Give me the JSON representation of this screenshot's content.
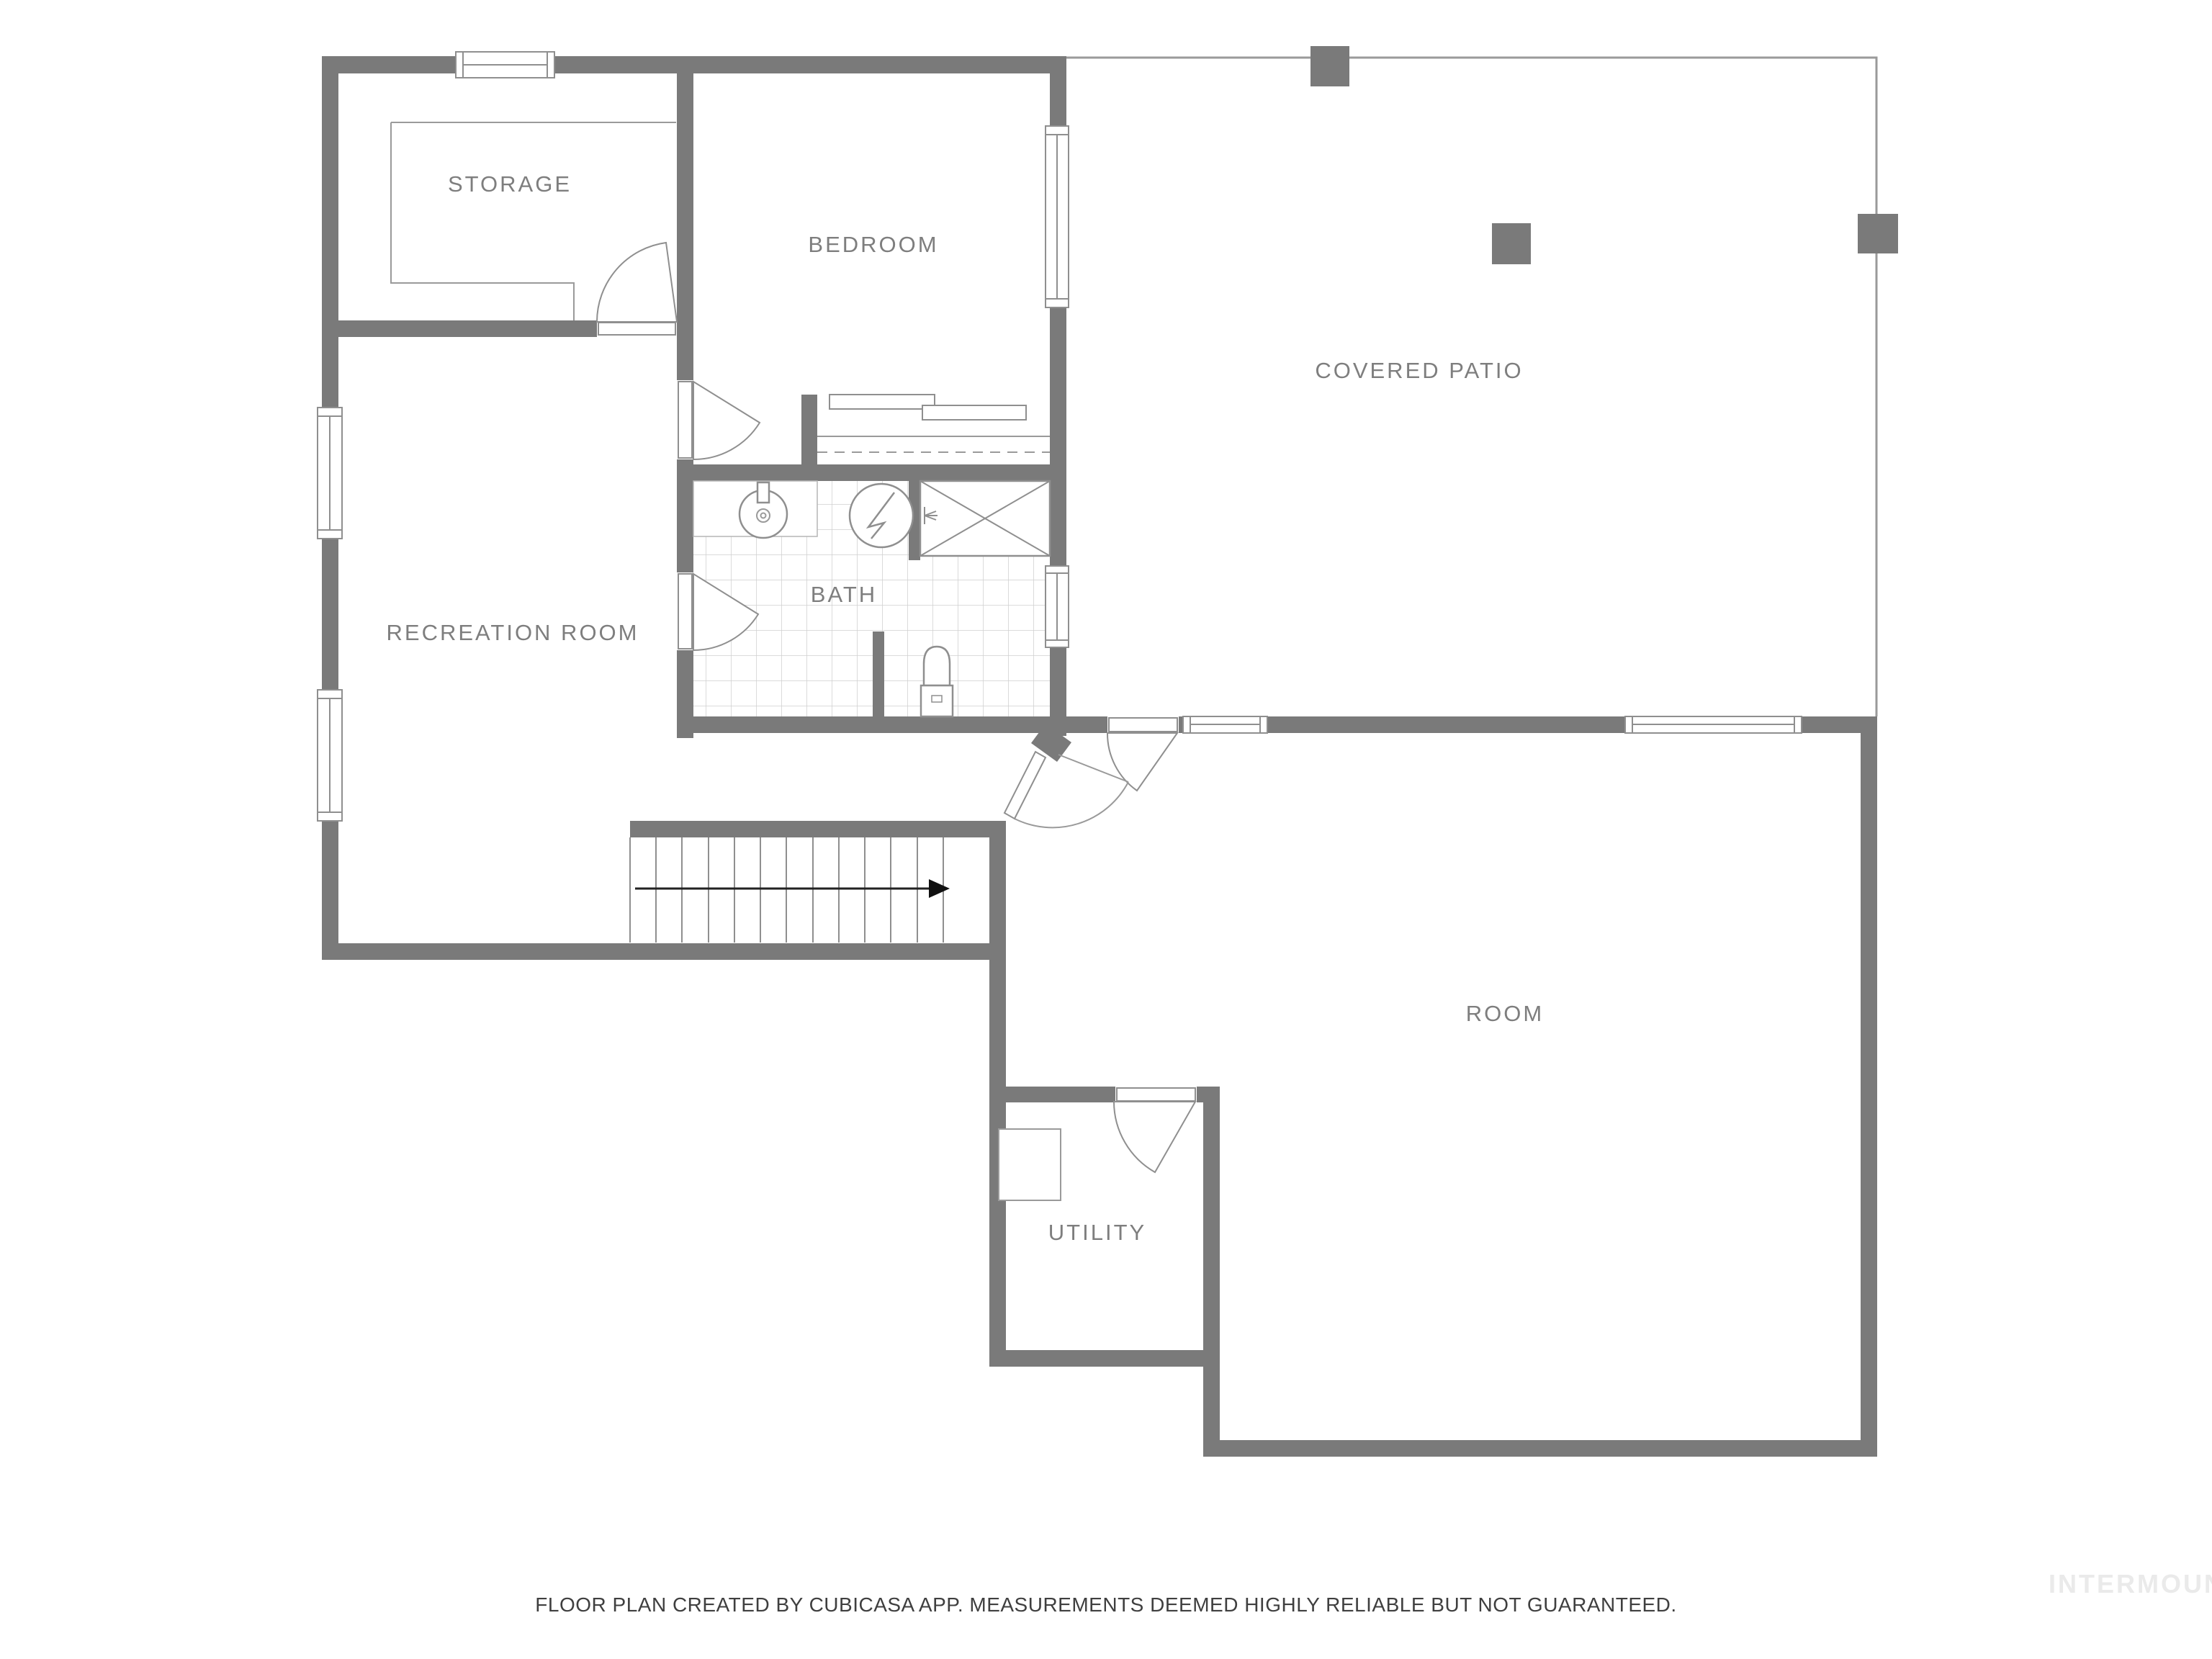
{
  "rooms": {
    "storage": {
      "label": "STORAGE"
    },
    "bedroom": {
      "label": "BEDROOM"
    },
    "covered_patio": {
      "label": "COVERED PATIO"
    },
    "recreation_room": {
      "label": "RECREATION ROOM"
    },
    "bath": {
      "label": "BATH"
    },
    "room": {
      "label": "ROOM"
    },
    "utility": {
      "label": "UTILITY"
    }
  },
  "footer": {
    "disclaimer": "FLOOR PLAN CREATED BY CUBICASA APP. MEASUREMENTS DEEMED HIGHLY RELIABLE BUT NOT GUARANTEED."
  },
  "watermark": "INTERMOUNTAIN",
  "colors": {
    "wall": "#7a7a7a",
    "patio_outline": "#9a9a9a",
    "tile_line": "#cfcfcf",
    "fixture_line": "#8f8f8f",
    "label_text": "#7e7e7e",
    "footer_text": "#3f3f3f",
    "watermark_text": "#eaeaea",
    "stair_arrow": "#111111",
    "background": "#ffffff"
  }
}
